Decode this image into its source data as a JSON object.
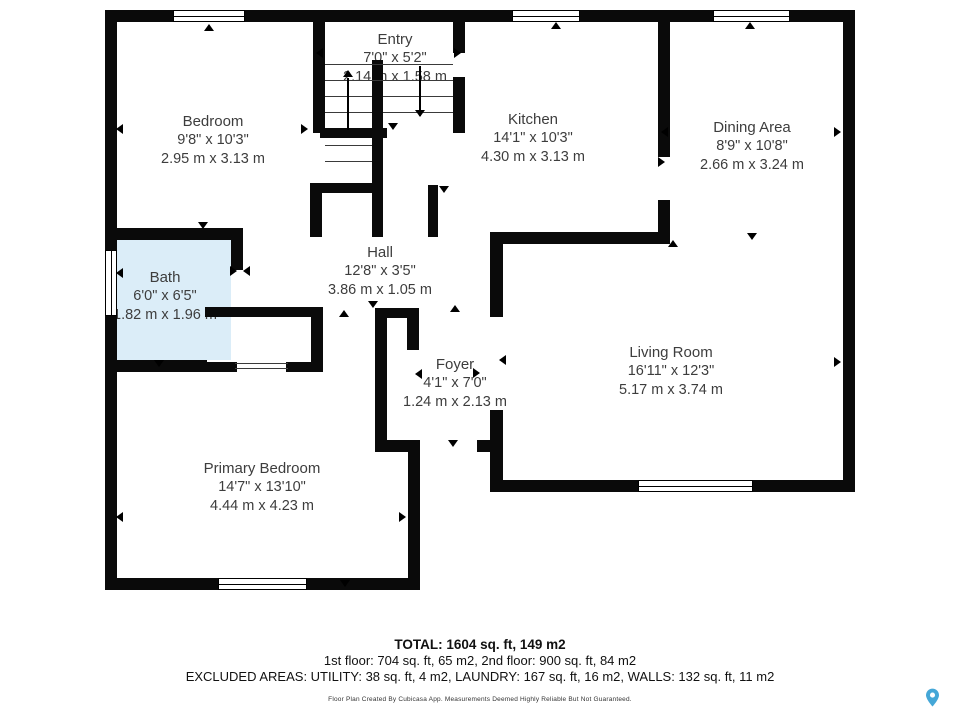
{
  "rooms": {
    "entry": {
      "name": "Entry",
      "imperial": "7'0\" x 5'2\"",
      "metric": "2.14 m x 1.58 m"
    },
    "bedroom": {
      "name": "Bedroom",
      "imperial": "9'8\" x 10'3\"",
      "metric": "2.95 m x 3.13 m"
    },
    "kitchen": {
      "name": "Kitchen",
      "imperial": "14'1\" x 10'3\"",
      "metric": "4.30 m x 3.13 m"
    },
    "dining": {
      "name": "Dining Area",
      "imperial": "8'9\" x 10'8\"",
      "metric": "2.66 m x 3.24 m"
    },
    "hall": {
      "name": "Hall",
      "imperial": "12'8\" x 3'5\"",
      "metric": "3.86 m x 1.05 m"
    },
    "bath": {
      "name": "Bath",
      "imperial": "6'0\" x 6'5\"",
      "metric": "1.82 m x 1.96 m"
    },
    "foyer": {
      "name": "Foyer",
      "imperial": "4'1\" x 7'0\"",
      "metric": "1.24 m x 2.13 m"
    },
    "living": {
      "name": "Living Room",
      "imperial": "16'11\" x 12'3\"",
      "metric": "5.17 m x 3.74 m"
    },
    "primary": {
      "name": "Primary Bedroom",
      "imperial": "14'7\" x 13'10\"",
      "metric": "4.44 m x 4.23 m"
    }
  },
  "summary": {
    "total": "TOTAL: 1604 sq. ft, 149 m2",
    "floors": "1st floor: 704 sq. ft, 65 m2, 2nd floor: 900 sq. ft, 84 m2",
    "excluded": "EXCLUDED AREAS: UTILITY: 38 sq. ft, 4 m2, LAUNDRY: 167 sq. ft, 16 m2, WALLS: 132 sq. ft, 11 m2"
  },
  "disclaimer": "Floor Plan Created By Cubicasa App. Measurements Deemed Highly Reliable But Not Guaranteed.",
  "colors": {
    "wall": "#0a0a0a",
    "bath_fill": "#dbedf8",
    "pin_blue": "#45a7d7"
  }
}
